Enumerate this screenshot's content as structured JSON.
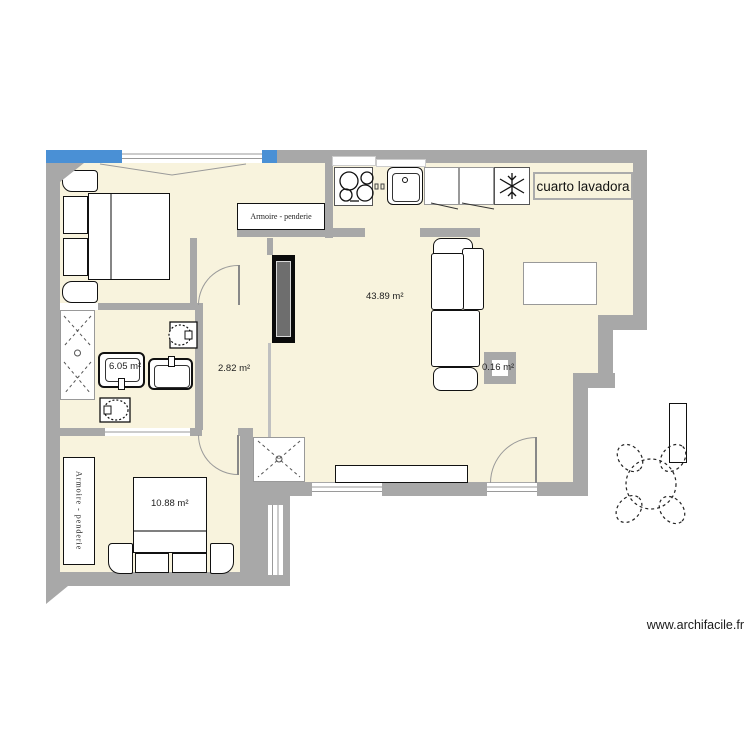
{
  "colors": {
    "wall": "#a8a8a8",
    "floor": "#f8f3dd",
    "window": "#4a90d5",
    "arc": "#999999"
  },
  "rooms": {
    "living": {
      "area_label": "43.89 m²"
    },
    "hallway": {
      "area_label": "2.82 m²"
    },
    "bathroom": {
      "area_label": "6.05 m²"
    },
    "bedroom_bottom": {
      "area_label": "10.88 m²"
    },
    "column": {
      "area_label": "0.16 m²"
    },
    "laundry": {
      "name_label": "cuarto lavadora"
    }
  },
  "furniture": {
    "wardrobe_top_label": "Armoire - penderie",
    "wardrobe_bottom_label": "Armoire - penderie"
  },
  "watermark": "www.archifacile.fr"
}
